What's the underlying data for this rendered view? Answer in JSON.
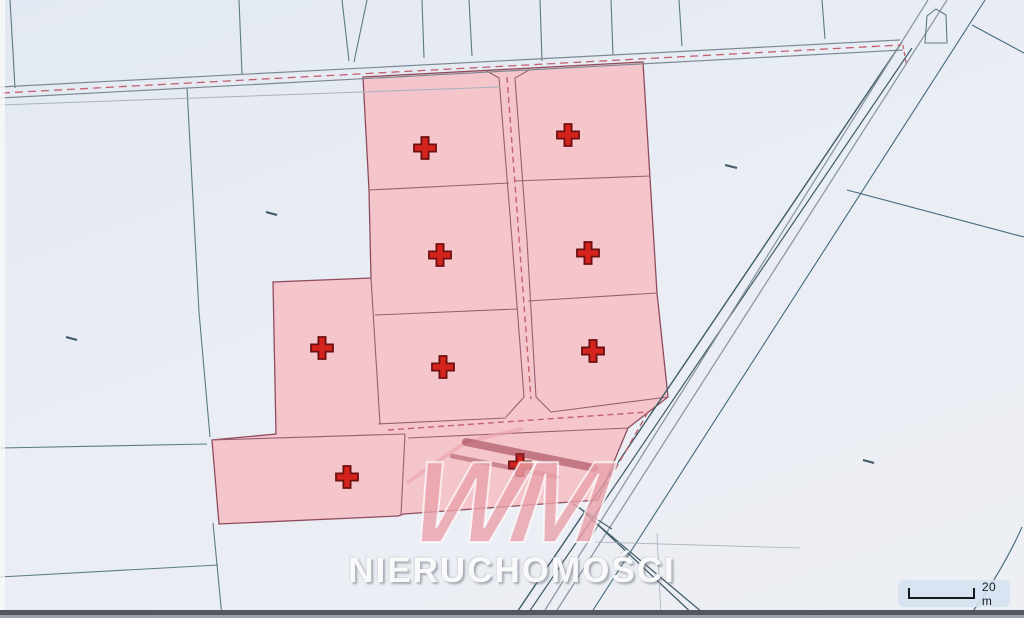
{
  "watermark": {
    "logo": "WM",
    "name": "NIERUCHOMOŚCI"
  },
  "scale_bar": {
    "label": "20 m"
  },
  "map": {
    "background": "#e9edf4",
    "palette": {
      "teal": "#5c7a82",
      "blue": "#44687e",
      "slate": "#3f5a68",
      "gray": "#87929e",
      "lightgray": "#a8b2bc",
      "road": "#7b8a90",
      "red": "#c4606c"
    },
    "block": {
      "fill": "#f4c6cc",
      "stroke": "#8f4b5e",
      "line_color": "#9a5d6e",
      "outer": [
        [
          363,
          77
        ],
        [
          643,
          62
        ],
        [
          650,
          178
        ],
        [
          657,
          293
        ],
        [
          668,
          397
        ],
        [
          628,
          428
        ],
        [
          598,
          500
        ],
        [
          404,
          514
        ],
        [
          398,
          516
        ],
        [
          219,
          524
        ],
        [
          212,
          440
        ],
        [
          276,
          434
        ],
        [
          273,
          282
        ],
        [
          371,
          278
        ],
        [
          369,
          190
        ]
      ],
      "internal": [
        [
          [
            369,
            190
          ],
          [
            509,
            183
          ]
        ],
        [
          [
            514,
            181
          ],
          [
            650,
            176
          ]
        ],
        [
          [
            375,
            315
          ],
          [
            517,
            309
          ]
        ],
        [
          [
            528,
            301
          ],
          [
            657,
            293
          ]
        ],
        [
          [
            371,
            278
          ],
          [
            380,
            424
          ]
        ],
        [
          [
            485,
            70
          ],
          [
            499,
            78
          ],
          [
            512,
            240
          ],
          [
            524,
            397
          ],
          [
            506,
            417
          ]
        ],
        [
          [
            529,
            70
          ],
          [
            515,
            78
          ],
          [
            527,
            240
          ],
          [
            536,
            397
          ],
          [
            551,
            412
          ]
        ],
        [
          [
            378,
            424
          ],
          [
            506,
            418
          ]
        ],
        [
          [
            551,
            412
          ],
          [
            668,
            397
          ]
        ],
        [
          [
            212,
            440
          ],
          [
            405,
            434
          ]
        ],
        [
          [
            408,
            438
          ],
          [
            628,
            428
          ]
        ],
        [
          [
            405,
            434
          ],
          [
            401,
            515
          ]
        ]
      ]
    },
    "parcels": [
      {
        "id": 1,
        "cross": [
          425,
          148
        ]
      },
      {
        "id": 2,
        "cross": [
          568,
          135
        ]
      },
      {
        "id": 3,
        "cross": [
          440,
          255
        ]
      },
      {
        "id": 4,
        "cross": [
          588,
          253
        ]
      },
      {
        "id": 5,
        "cross": [
          322,
          348
        ]
      },
      {
        "id": 6,
        "cross": [
          443,
          367
        ]
      },
      {
        "id": 7,
        "cross": [
          593,
          351
        ]
      },
      {
        "id": 8,
        "cross": [
          347,
          477
        ]
      },
      {
        "id": 9,
        "cross": [
          520,
          465
        ]
      }
    ],
    "cross_style": {
      "arm": 11,
      "thickness": 3.6,
      "fill": "#d5231d",
      "stroke": "#6e0f0f"
    },
    "lines": [
      {
        "pts": [
          [
            10,
            0
          ],
          [
            15,
            88
          ]
        ],
        "c": "teal",
        "w": 1.1
      },
      {
        "pts": [
          [
            239,
            0
          ],
          [
            242,
            74
          ]
        ],
        "c": "teal",
        "w": 1.1
      },
      {
        "pts": [
          [
            342,
            0
          ],
          [
            349,
            61
          ]
        ],
        "c": "teal",
        "w": 1.1
      },
      {
        "pts": [
          [
            367,
            0
          ],
          [
            354,
            62
          ]
        ],
        "c": "teal",
        "w": 1.1
      },
      {
        "pts": [
          [
            422,
            0
          ],
          [
            424,
            58
          ]
        ],
        "c": "teal",
        "w": 1.1
      },
      {
        "pts": [
          [
            469,
            0
          ],
          [
            472,
            56
          ]
        ],
        "c": "teal",
        "w": 1.1
      },
      {
        "pts": [
          [
            540,
            0
          ],
          [
            542,
            61
          ]
        ],
        "c": "teal",
        "w": 1.1
      },
      {
        "pts": [
          [
            611,
            0
          ],
          [
            613,
            55
          ]
        ],
        "c": "teal",
        "w": 1.1
      },
      {
        "pts": [
          [
            679,
            0
          ],
          [
            682,
            46
          ]
        ],
        "c": "teal",
        "w": 1.1
      },
      {
        "pts": [
          [
            822,
            0
          ],
          [
            825,
            39
          ]
        ],
        "c": "teal",
        "w": 1.1
      },
      {
        "pts": [
          [
            187,
            88
          ],
          [
            199,
            312
          ],
          [
            210,
            437
          ]
        ],
        "c": "teal",
        "w": 1.1
      },
      {
        "pts": [
          [
            213,
            523
          ],
          [
            222,
            617
          ]
        ],
        "c": "teal",
        "w": 1.1
      },
      {
        "pts": [
          [
            0,
            448
          ],
          [
            207,
            444
          ]
        ],
        "c": "teal",
        "w": 1.1
      },
      {
        "pts": [
          [
            0,
            577
          ],
          [
            218,
            565
          ]
        ],
        "c": "teal",
        "w": 1.1
      },
      {
        "pts": [
          [
            0,
            87
          ],
          [
            900,
            40
          ]
        ],
        "c": "road",
        "w": 1.2
      },
      {
        "pts": [
          [
            0,
            98
          ],
          [
            903,
            50
          ]
        ],
        "c": "road",
        "w": 1.2
      },
      {
        "pts": [
          [
            0,
            105
          ],
          [
            500,
            87
          ]
        ],
        "c": "lightgray",
        "w": 1.0
      },
      {
        "pts": [
          [
            902,
            42
          ],
          [
            513,
            618
          ]
        ],
        "c": "slate",
        "w": 1.4
      },
      {
        "pts": [
          [
            912,
            48
          ],
          [
            525,
            618
          ]
        ],
        "c": "slate",
        "w": 1.2
      },
      {
        "pts": [
          [
            928,
            0
          ],
          [
            540,
            618
          ]
        ],
        "c": "gray",
        "w": 1.2
      },
      {
        "pts": [
          [
            947,
            0
          ],
          [
            552,
            618
          ]
        ],
        "c": "gray",
        "w": 1.2
      },
      {
        "pts": [
          [
            985,
            0
          ],
          [
            588,
            618
          ]
        ],
        "c": "blue",
        "w": 1.1
      },
      {
        "pts": [
          [
            580,
            508
          ],
          [
            697,
            618
          ]
        ],
        "c": "slate",
        "w": 1.3
      },
      {
        "pts": [
          [
            591,
            519
          ],
          [
            709,
            618
          ]
        ],
        "c": "slate",
        "w": 1.2
      },
      {
        "pts": [
          [
            573,
            504
          ],
          [
            612,
            529
          ]
        ],
        "c": "slate",
        "w": 1.1
      },
      {
        "pts": [
          [
            972,
            25
          ],
          [
            1024,
            53
          ]
        ],
        "c": "blue",
        "w": 1.1
      },
      {
        "pts": [
          [
            847,
            190
          ],
          [
            1024,
            237
          ]
        ],
        "c": "blue",
        "w": 1.1
      },
      {
        "pts": [
          [
            595,
            542
          ],
          [
            800,
            548
          ]
        ],
        "c": "lightgray",
        "w": 0.8
      },
      {
        "pts": [
          [
            657,
            533
          ],
          [
            661,
            618
          ]
        ],
        "c": "lightgray",
        "w": 0.8
      },
      {
        "pts": [
          [
            925,
            43
          ],
          [
            927,
            16
          ],
          [
            936,
            9
          ],
          [
            946,
            15
          ],
          [
            947,
            43
          ]
        ],
        "c": "teal",
        "w": 1.1,
        "closed": true
      }
    ],
    "curves": [
      {
        "d": "M1022,527 Q1002,572 968,618",
        "c": "blue",
        "w": 1.1
      }
    ],
    "red_dashes": [
      {
        "pts": [
          [
            2,
            93
          ],
          [
            901,
            45
          ]
        ],
        "d": "8 5",
        "w": 1.3
      },
      {
        "pts": [
          [
            903,
            45
          ],
          [
            906,
            63
          ]
        ],
        "d": "4 3",
        "w": 1.3
      },
      {
        "pts": [
          [
            507,
            77
          ],
          [
            531,
            399
          ]
        ],
        "d": "6 4",
        "w": 1.4
      },
      {
        "pts": [
          [
            388,
            430
          ],
          [
            648,
            412
          ]
        ],
        "d": "6 4",
        "w": 1.4
      },
      {
        "pts": [
          [
            648,
            412
          ],
          [
            604,
            489
          ]
        ],
        "d": "6 4",
        "w": 1.4
      }
    ],
    "ticks": [
      [
        [
          266,
          212
        ],
        [
          277,
          215
        ]
      ],
      [
        [
          66,
          337
        ],
        [
          77,
          340
        ]
      ],
      [
        [
          725,
          165
        ],
        [
          737,
          168
        ]
      ],
      [
        [
          863,
          460
        ],
        [
          874,
          463
        ]
      ]
    ],
    "watermark_roof": [
      {
        "d": "M408,482 L466,442 L521,429",
        "color": "rgba(236,164,173,0.65)",
        "w": 4
      },
      {
        "d": "M466,442 L594,468",
        "color": "rgba(148,42,58,0.50)",
        "w": 8
      },
      {
        "d": "M452,456 L557,477",
        "color": "rgba(148,42,58,0.42)",
        "w": 4.5
      }
    ]
  }
}
